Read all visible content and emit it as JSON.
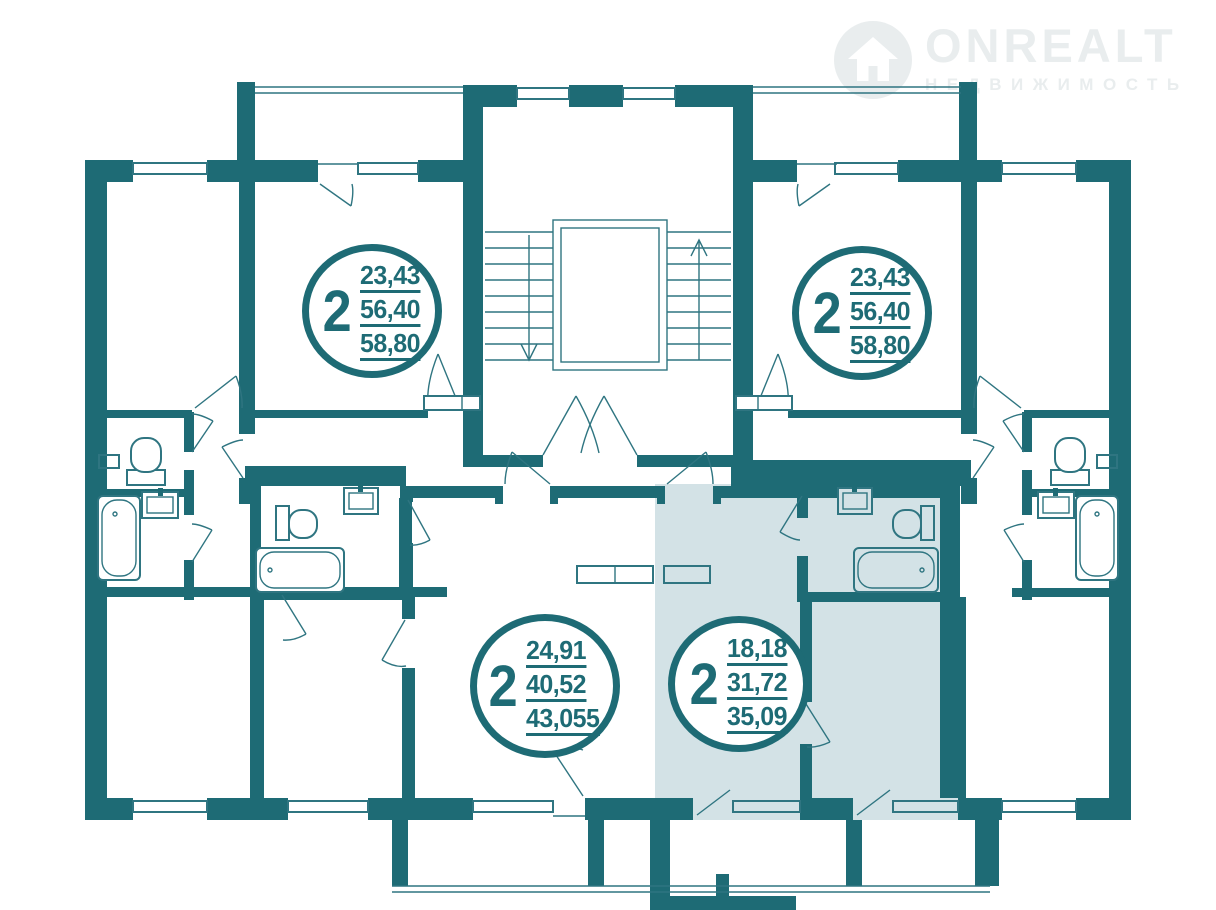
{
  "watermark": {
    "brand": "ONREALT",
    "tagline": "НЕДВИЖИМОСТЬ"
  },
  "apartments": [
    {
      "id": "top-left",
      "rooms": "2",
      "areas": [
        "23,43",
        "56,40",
        "58,80"
      ],
      "highlighted": false
    },
    {
      "id": "top-right",
      "rooms": "2",
      "areas": [
        "23,43",
        "56,40",
        "58,80"
      ],
      "highlighted": false
    },
    {
      "id": "bottom-middle",
      "rooms": "2",
      "areas": [
        "24,91",
        "40,52",
        "43,055"
      ],
      "highlighted": false
    },
    {
      "id": "bottom-right",
      "rooms": "2",
      "areas": [
        "18,18",
        "31,72",
        "35,09"
      ],
      "highlighted": true
    }
  ],
  "colors": {
    "wall": "#1e6b75",
    "line": "#2f7581",
    "highlight": "#d3e2e6",
    "watermark": "#e9edee"
  }
}
